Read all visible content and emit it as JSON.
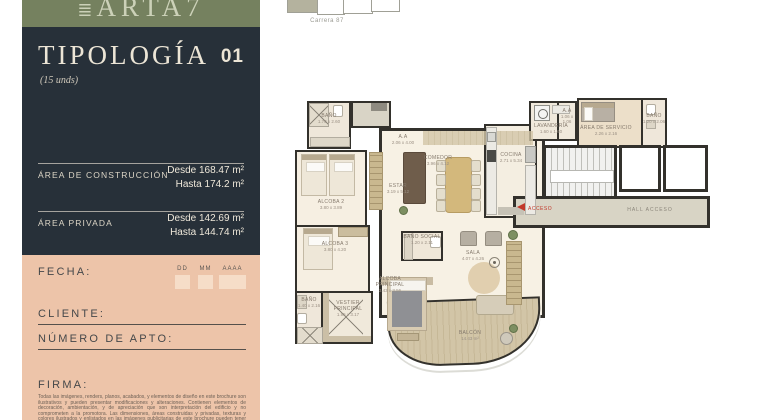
{
  "brand": {
    "logo_icon": "≣",
    "logo_text": "ARTA7"
  },
  "siteplan": {
    "street_label": "Carrera 87"
  },
  "sidebar": {
    "title": "TIPOLOGÍA",
    "number": "01",
    "units_note": "(15 unds)",
    "areas": [
      {
        "label": "ÁREA DE CONSTRUCCIÓN",
        "from": "Desde 168.47 m²",
        "to": "Hasta 174.2 m²"
      },
      {
        "label": "ÁREA PRIVADA",
        "from": "Desde 142.69 m²",
        "to": "Hasta 144.74 m²"
      }
    ],
    "form": {
      "fecha_label": "FECHA:",
      "date_dd": "DD",
      "date_mm": "MM",
      "date_aaaa": "AAAA",
      "cliente_label": "CLIENTE:",
      "numero_apto_label": "NÚMERO DE APTO:",
      "firma_label": "FIRMA:",
      "disclaimer": "Todas las imágenes, renders, planos, acabados, y elementos de diseño en este brochure son ilustrativos y pueden presentar modificaciones y alteraciones. Contienen elementos de decoración, ambientación, y de apreciación que son interpretación del edificio y no comprometen a la promotora. Las dimensiones, áreas construidas y privadas, texturas y colores ilustrados y enlistados en las imágenes publicitarias de este brochure pueden tener variaciones por efecto de la coordinación técnica, diseños técnicos finales."
    }
  },
  "colors": {
    "logo_band": "#75815f",
    "dark_panel": "#273039",
    "pink_panel": "#edc4a9",
    "accent_red": "#c2392b",
    "plan_floor": "#f6efe2",
    "hall_floor": "#d8d4c5"
  },
  "floorplan": {
    "access_label": "ACCESO",
    "hall_label": "HALL ACCESO",
    "rooms": {
      "bano_2": {
        "name": "BAÑO",
        "dims": "1.70 x 2.60"
      },
      "alcoba_2": {
        "name": "ALCOBA 2",
        "dims": "3.80 x 3.89"
      },
      "aa_1": {
        "name": "A.A",
        "dims": "2.06 x 4.00"
      },
      "estar": {
        "name": "ESTAR",
        "dims": "3.19 x 5.12"
      },
      "comedor": {
        "name": "COMEDOR",
        "dims": "3.96 x 4.12"
      },
      "cocina": {
        "name": "COCINA",
        "dims": "2.71 x 5.34"
      },
      "lavanderia": {
        "name": "LAVANDERÍA",
        "dims": "1.60 x 1.60"
      },
      "aa_2": {
        "name": "A.A",
        "dims": "1.06 x 1.06"
      },
      "area_servicio": {
        "name": "ÁREA DE SERVICIO",
        "dims": "2.26 x 2.16"
      },
      "bano_servicio": {
        "name": "BAÑO",
        "dims": "1.20 x 2.06"
      },
      "alcoba_3": {
        "name": "ALCOBA 3",
        "dims": "3.80 x 4.20"
      },
      "bano_3": {
        "name": "BAÑO",
        "dims": "1.40 x 2.16"
      },
      "vestier": {
        "name": "VESTIER PRINCIPAL",
        "dims": "1.95 x 3.17"
      },
      "bano_social": {
        "name": "BAÑO SOCIAL",
        "dims": "1.20 x 2.11"
      },
      "alcoba_principal": {
        "name": "ALCOBA PRINCIPAL",
        "dims": "3.43 x 3.56"
      },
      "sala": {
        "name": "SALA",
        "dims": "4.07 x 4.26"
      },
      "balcon": {
        "name": "BALCÓN",
        "dims": "14.43 m²"
      }
    }
  }
}
